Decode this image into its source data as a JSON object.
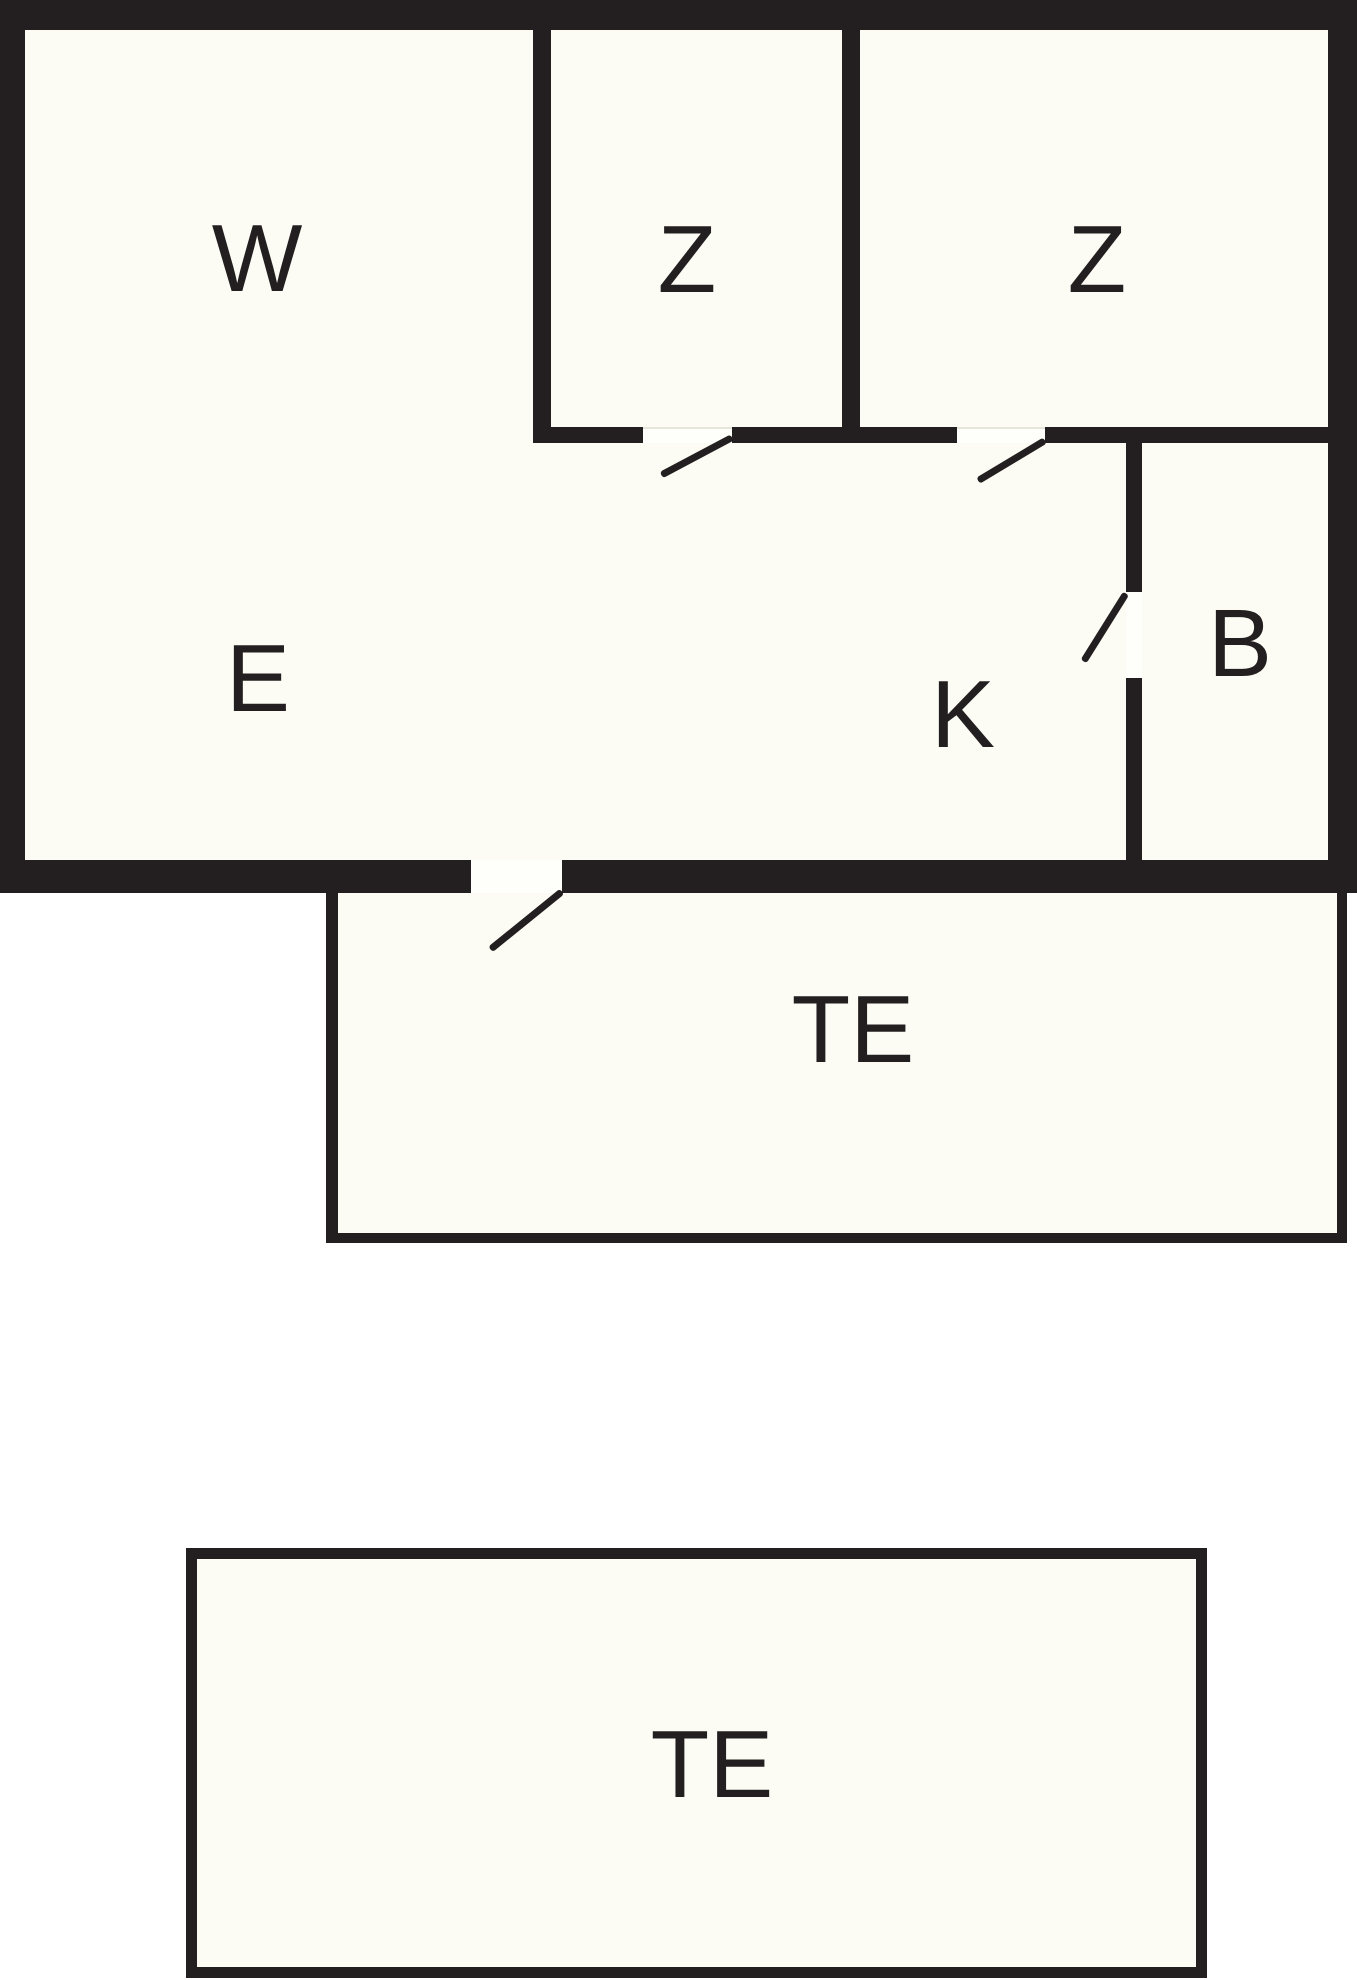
{
  "rooms": [
    {
      "id": "w",
      "label": "W"
    },
    {
      "id": "z1",
      "label": "Z"
    },
    {
      "id": "z2",
      "label": "Z"
    },
    {
      "id": "e",
      "label": "E"
    },
    {
      "id": "k",
      "label": "K"
    },
    {
      "id": "b",
      "label": "B"
    },
    {
      "id": "te_attached",
      "label": "TE"
    },
    {
      "id": "te_detached",
      "label": "TE"
    }
  ],
  "colors": {
    "wall": "#231f20",
    "floor": "#fcfcf5",
    "background": "#ffffff"
  }
}
